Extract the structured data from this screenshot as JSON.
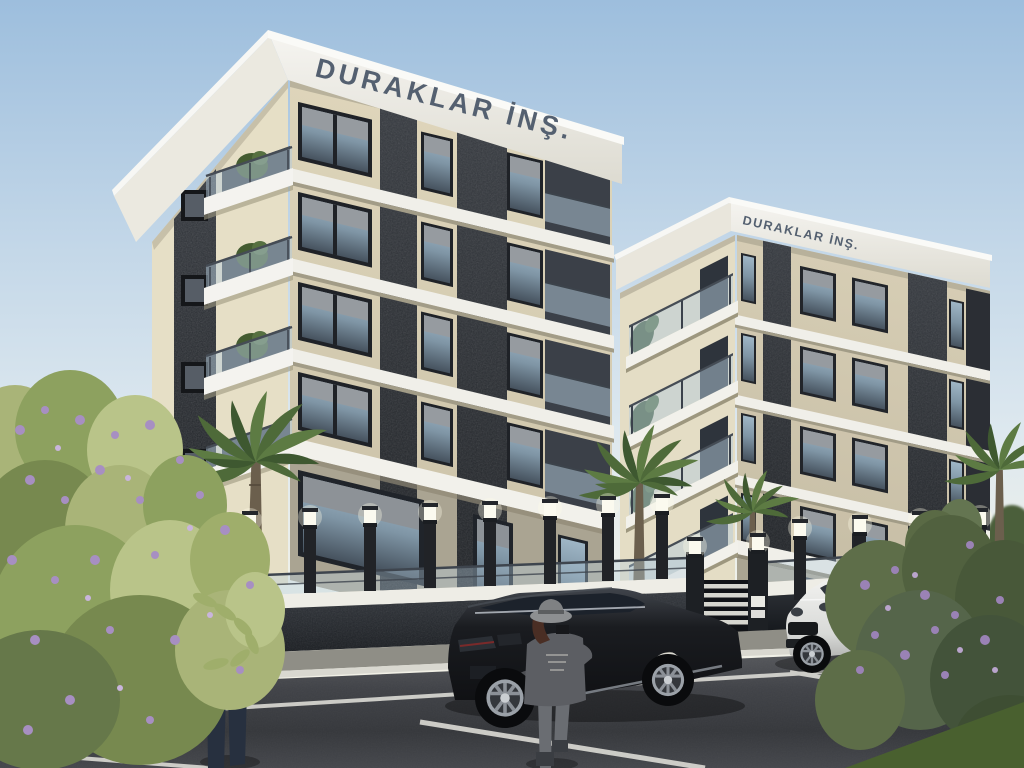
{
  "signs": {
    "building_1": "DURAKLAR İNŞ.",
    "building_2": "DURAKLAR İNŞ."
  },
  "palette": {
    "sky_top": "#9dbedd",
    "sky_mid": "#c3d7e8",
    "horizon_warm": "#f4f0e2",
    "facade_light": "#e6dfc6",
    "facade_shade": "#d8cfb6",
    "facade_ground": "#aaa492",
    "stone_dark": "#24272c",
    "slab_white": "#f2f1eb",
    "sign_text": "#546070",
    "glass_sky": "#9fb6c6",
    "glass_deep": "#46525e",
    "railing_glass": "#b5ccdc",
    "fence_wall": "#1f2226",
    "fence_band": "#eeede6",
    "lamp_white": "#fbfaef",
    "road_dark": "#3a3c40",
    "marking_white": "#dcdbd5",
    "sidewalk_gray": "#8f8e86",
    "car_black_body": "#101114",
    "suv_white_body": "#f2f2f0",
    "shirt_red": "#b32821",
    "jeans_dark": "#27303f",
    "outfit_gray": "#5c5e63",
    "hat_gray": "#8d8f91",
    "foliage_light": "#a9b478",
    "foliage_dark": "#55683f",
    "palm_green": "#4e6a39",
    "trunk_brown": "#6b5f4d",
    "flower_purple": "#a78fc2",
    "grass_green": "#49602f"
  }
}
